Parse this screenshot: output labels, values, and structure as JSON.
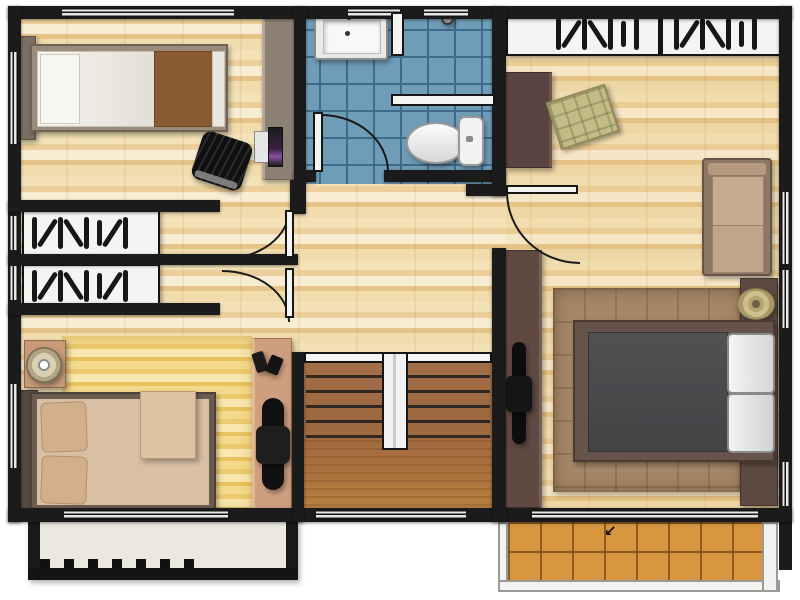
{
  "meta": {
    "type": "architectural-floor-plan",
    "view": "top-down",
    "visible_text": "none"
  },
  "palette": {
    "wall": "#1b1b1b",
    "wood_light": "#f3e2b8",
    "wood_dark": "#e6c488",
    "bath_tile": "#6f9db8",
    "bath_grout": "#3f6b8a",
    "stair_wood": "#9c6840",
    "balcony_tile": "#d8973f",
    "balcony_rail_white": "#f2f2f0",
    "master_rug": "#a58668",
    "yellow_rug": "#f2d684",
    "blanket_brown": "#8a5a33",
    "bedding_tan": "#d9bfa4",
    "mattress_grey": "#48484b",
    "dark_furniture": "#5a4440",
    "cushion_green": "#c2bd86",
    "lamp_gold": "#cfc08b",
    "desk_salmon": "#cf9e7f",
    "desk_taupe": "#8d8173"
  },
  "icons": {
    "balcony_arrow": "↙",
    "hanger_icon": "top-view clothes hangers",
    "window_icon": "double-line plan window"
  },
  "rooms": [
    {
      "name": "bedroom-1",
      "position": "top-left",
      "furniture": [
        "single-bed with brown blanket",
        "headboard",
        "wall desk",
        "laptop",
        "black lounge chair"
      ]
    },
    {
      "name": "bathroom",
      "position": "top-center",
      "furniture": [
        "bathtub",
        "shower partition",
        "shower head",
        "toilet",
        "swing door"
      ]
    },
    {
      "name": "walk-in-closet-1",
      "position": "left-middle-upper",
      "furniture": [
        "wardrobe with hangers"
      ]
    },
    {
      "name": "walk-in-closet-2",
      "position": "left-middle-lower",
      "furniture": [
        "wardrobe with hangers"
      ]
    },
    {
      "name": "bedroom-2",
      "position": "bottom-left",
      "furniture": [
        "double-bed tan bedding",
        "two pillows",
        "folded blanket",
        "nightstand",
        "round lamp",
        "striped rug",
        "desk",
        "office chair",
        "speakers"
      ]
    },
    {
      "name": "hallway",
      "position": "center",
      "furniture": [
        "two swing doors to closets",
        "door to master bedroom"
      ]
    },
    {
      "name": "staircase",
      "position": "bottom-center",
      "furniture": [
        "treads",
        "center railing"
      ]
    },
    {
      "name": "master-bedroom",
      "position": "right",
      "furniture": [
        "built-in wardrobe with hangers",
        "dresser",
        "green floor cushion",
        "loveseat sofa",
        "tv cabinet",
        "television",
        "double-bed grey mattress",
        "two white pillows",
        "tufted rug",
        "side shelf",
        "round gold lamp"
      ]
    },
    {
      "name": "balcony-left",
      "position": "bottom-left-outside",
      "furniture": [
        "railing with posts"
      ]
    },
    {
      "name": "balcony-right",
      "position": "bottom-right-outside",
      "furniture": [
        "orange tile floor",
        "white railing",
        "entry arrow"
      ]
    }
  ]
}
